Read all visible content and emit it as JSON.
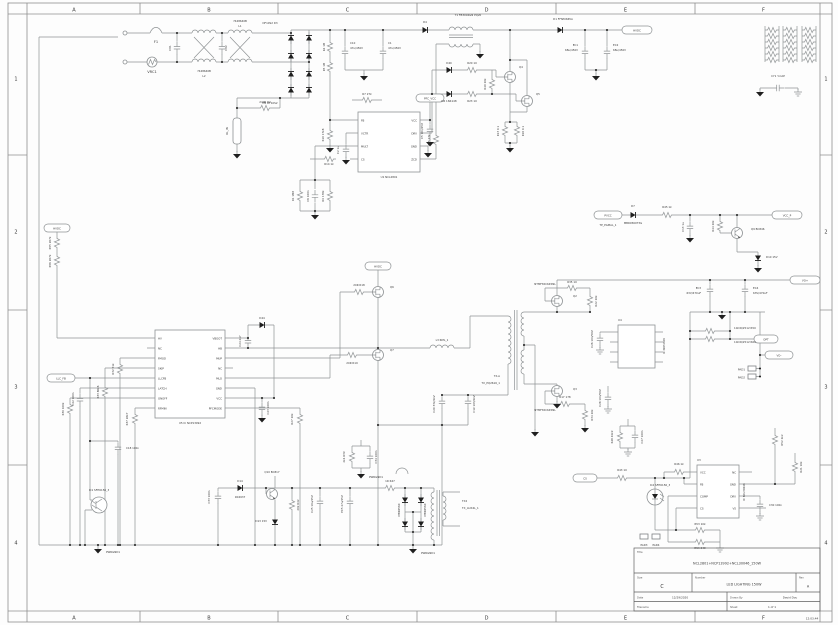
{
  "sheet": {
    "cols": [
      "A",
      "B",
      "C",
      "D",
      "E",
      "F"
    ],
    "rows": [
      "1",
      "2",
      "3",
      "4"
    ],
    "print_time": "12:03:44"
  },
  "title_block": {
    "title_label": "Title",
    "title": "NCL2801+NCP13992+NCL30046_150W",
    "size_label": "Size",
    "size": "C",
    "number_label": "Number",
    "number": "LED LIGHTING 150W",
    "rev_label": "Rev",
    "rev": "A",
    "date_label": "Date",
    "date": "12/29/2020",
    "drawn_by_label": "Drawn By",
    "drawn_by": "David Dou",
    "filename_label": "Filename",
    "sheet_label": "Sheet",
    "sheet_value": "1    of    1"
  },
  "schematic": {
    "labels": [
      [
        "F1",
        156,
        43
      ],
      [
        "VRC1",
        152,
        73
      ],
      [
        "CX1",
        171,
        48,
        "vs"
      ],
      [
        "CX2",
        227,
        48,
        "vs"
      ],
      [
        "7448640B",
        204,
        72,
        "s"
      ],
      [
        "L2",
        204,
        77,
        "s"
      ],
      [
        "7448640B",
        240,
        22,
        "s"
      ],
      [
        "L1",
        240,
        27,
        "s"
      ],
      [
        "DF10S2 D3",
        270,
        24,
        "s"
      ],
      [
        "D5 DF10S2",
        270,
        104,
        "s"
      ],
      [
        "240R R2",
        265,
        103,
        "s"
      ],
      [
        "RL_IN",
        228,
        131,
        "vs"
      ],
      [
        "C10",
        350,
        44,
        "ls"
      ],
      [
        "47u/450V",
        350,
        49,
        "ls"
      ],
      [
        "C1",
        388,
        44,
        "ls"
      ],
      [
        "47u/450V",
        388,
        49,
        "ls"
      ],
      [
        "R4 1M",
        325,
        47,
        "vs"
      ],
      [
        "R5 1M",
        325,
        67,
        "vs"
      ],
      [
        "R10 17k8",
        324,
        135,
        "vs"
      ],
      [
        "D4",
        425,
        23,
        "s"
      ],
      [
        "T1 FB3004GN PQ20",
        468,
        16,
        "s"
      ],
      [
        "D1 FFSP0665A",
        563,
        20,
        "s"
      ],
      [
        "EC1",
        578,
        46,
        "es"
      ],
      [
        "68u/450V",
        578,
        51,
        "es"
      ],
      [
        "EC2",
        613,
        46,
        "ls"
      ],
      [
        "68u/450V",
        613,
        51,
        "ls"
      ],
      [
        "HVDC",
        637,
        31.3,
        "s"
      ],
      [
        "R15 27k",
        430,
        140,
        "vs"
      ],
      [
        "R7 27k",
        367,
        95,
        "s"
      ],
      [
        "Q4",
        519,
        68,
        "ls"
      ],
      [
        "Q5",
        536,
        95,
        "ls"
      ],
      [
        "D40",
        449,
        64,
        "s"
      ],
      [
        "R20 10",
        472,
        64,
        "s"
      ],
      [
        "D6 1N4148",
        449,
        102,
        "s"
      ],
      [
        "R23 10",
        472,
        102,
        "s"
      ],
      [
        "R40 20k",
        486,
        84,
        "vs"
      ],
      [
        "R13 0.1",
        499,
        131,
        "vs"
      ],
      [
        "R16 0.1",
        524,
        131,
        "vs"
      ],
      [
        "FB",
        361,
        121.3,
        "ls"
      ],
      [
        "VCTR",
        361,
        134.3,
        "ls"
      ],
      [
        "MULT",
        361,
        147.3,
        "ls"
      ],
      [
        "CS",
        361,
        160.3,
        "ls"
      ],
      [
        "VCC",
        417,
        121.3,
        "es"
      ],
      [
        "DRV",
        417,
        134.3,
        "es"
      ],
      [
        "GND",
        417,
        147.3,
        "es"
      ],
      [
        "ZCD",
        417,
        160.3,
        "es"
      ],
      [
        "U1 NCL2801",
        389,
        178,
        "s"
      ],
      [
        "PFC_VCC",
        430,
        99.3,
        "s"
      ],
      [
        "C5 10n/25V",
        423,
        131,
        "vs"
      ],
      [
        "R14 1k",
        329,
        165,
        "s"
      ],
      [
        "C2 1u",
        339,
        150,
        "vs"
      ],
      [
        "R1 1M8",
        294,
        196,
        "vs"
      ],
      [
        "C6 100n",
        309,
        196,
        "vs"
      ],
      [
        "R9 178k",
        324,
        196,
        "vs"
      ],
      [
        "PVCC",
        608,
        216.3,
        "s"
      ],
      [
        "TP_PGMAL_1",
        608,
        226,
        "s"
      ],
      [
        "D7",
        633,
        207,
        "s"
      ],
      [
        "MBR0560T3G",
        633,
        224,
        "s"
      ],
      [
        "R45 1k",
        667,
        208,
        "s"
      ],
      [
        "C13 1u",
        684,
        227,
        "vs"
      ],
      [
        "R44 20k",
        714,
        226,
        "vs"
      ],
      [
        "Q9 BC846",
        751,
        230,
        "ls"
      ],
      [
        "D10 15V",
        766,
        258,
        "ls"
      ],
      [
        "VCC_P",
        787,
        216.3,
        "s"
      ],
      [
        "CY1 Y-CAP",
        778,
        77,
        "s"
      ],
      [
        "HVDC",
        57,
        229.3,
        "s"
      ],
      [
        "R55 267k",
        51,
        243,
        "vs"
      ],
      [
        "R56 267k",
        51,
        261,
        "vs"
      ],
      [
        "HV",
        158,
        339.3,
        "ls"
      ],
      [
        "NC",
        158,
        349.3,
        "ls"
      ],
      [
        "FMOD",
        158,
        359.3,
        "ls"
      ],
      [
        "SKIP",
        158,
        369.3,
        "ls"
      ],
      [
        "LLCFB",
        158,
        379.3,
        "ls"
      ],
      [
        "LATCH",
        158,
        389.3,
        "ls"
      ],
      [
        "ONOFF",
        158,
        399.3,
        "ls"
      ],
      [
        "RFMIN",
        158,
        409.3,
        "ls"
      ],
      [
        "VBOOT",
        222,
        339.3,
        "es"
      ],
      [
        "HB",
        222,
        349.3,
        "es"
      ],
      [
        "MUP",
        222,
        359.3,
        "es"
      ],
      [
        "NC",
        222,
        369.3,
        "es"
      ],
      [
        "MLO",
        222,
        379.3,
        "es"
      ],
      [
        "GND",
        222,
        389.3,
        "es"
      ],
      [
        "VCC",
        222,
        399.3,
        "es"
      ],
      [
        "PFCMODE",
        222,
        409.3,
        "es"
      ],
      [
        "U5 IC NCP13992",
        190,
        424,
        "s"
      ],
      [
        "R32 51k",
        114,
        369,
        "vs"
      ],
      [
        "R33 86k6",
        99,
        392,
        "vs"
      ],
      [
        "LLC_FB",
        61,
        379.3,
        "s"
      ],
      [
        "C22 100n",
        74,
        399,
        "vs"
      ],
      [
        "R30 100k",
        64,
        409,
        "vs"
      ],
      [
        "R37 28k7",
        128,
        419,
        "vs"
      ],
      [
        "C24 4n7",
        241,
        341,
        "vs"
      ],
      [
        "D44",
        262,
        319,
        "s"
      ],
      [
        "C23 100n",
        269,
        408,
        "vs"
      ],
      [
        "R27 20k",
        293,
        419,
        "vs"
      ],
      [
        "IC1 SFH6156_3",
        99,
        491,
        "s"
      ],
      [
        "C18 100n",
        126,
        449,
        "ls"
      ],
      [
        "PWRGND1",
        106,
        553,
        "ls"
      ],
      [
        "20R R18",
        359,
        286,
        "s"
      ],
      [
        "20R R19",
        352,
        364,
        "s"
      ],
      [
        "Q6",
        390,
        288,
        "ls"
      ],
      [
        "Q7",
        390,
        351,
        "ls"
      ],
      [
        "HVDC",
        378,
        267.3,
        "s"
      ],
      [
        "L3 RML_1",
        442,
        341,
        "s"
      ],
      [
        "C20 332/2kV",
        435,
        404,
        "vs"
      ],
      [
        "C19 103/2kV",
        475,
        404,
        "vs"
      ],
      [
        "TX-A",
        500,
        377,
        "es"
      ],
      [
        "TX_PQ2616_1",
        500,
        384,
        "es"
      ],
      [
        "NTMFS5C645NL",
        545,
        285,
        "s"
      ],
      [
        "Q2",
        573,
        297,
        "ls"
      ],
      [
        "R35 10",
        572,
        283,
        "s"
      ],
      [
        "R22 20k",
        597,
        301,
        "vs"
      ],
      [
        "NTMFS5C645NL",
        545,
        411,
        "s"
      ],
      [
        "Q3",
        573,
        390,
        "ls"
      ],
      [
        "R17 178",
        565,
        398,
        "s"
      ],
      [
        "R34 20k",
        593,
        415,
        "vs"
      ],
      [
        "U4",
        618,
        321,
        "ls"
      ],
      [
        "IC NCP4306",
        665,
        346,
        "vs"
      ],
      [
        "C26 10n/50V",
        593,
        339,
        "vs"
      ],
      [
        "C28 10n/50V",
        601,
        398,
        "vs"
      ],
      [
        "EC3",
        701,
        289,
        "es"
      ],
      [
        "63V/470uF",
        701,
        294,
        "es"
      ],
      [
        "EC4",
        753,
        289,
        "ls"
      ],
      [
        "63V/470uF",
        753,
        294,
        "ls"
      ],
      [
        "10mR/2512 R50",
        734,
        329,
        "ls"
      ],
      [
        "10mR/2512 R60",
        734,
        343,
        "ls"
      ],
      [
        "VO+",
        805,
        281.3,
        "s"
      ],
      [
        "VO-",
        779,
        356.3,
        "s"
      ],
      [
        "OPT",
        766,
        340.3,
        "s"
      ],
      [
        "PAD1",
        745,
        370.3,
        "es"
      ],
      [
        "PAD2",
        745,
        378.3,
        "es"
      ],
      [
        "C33 100n",
        210,
        497,
        "vs"
      ],
      [
        "D14",
        240,
        482,
        "s"
      ],
      [
        "1N4937",
        240,
        498,
        "s"
      ],
      [
        "Q10 BC817",
        272,
        473,
        "s"
      ],
      [
        "20k R42",
        299,
        505,
        "vs"
      ],
      [
        "D13 15V",
        267,
        522,
        "es"
      ],
      [
        "C25 10u/25V",
        313,
        504,
        "vs"
      ],
      [
        "EC5 47u/25V",
        343,
        504,
        "vs"
      ],
      [
        "1R R47",
        390,
        482,
        "s"
      ],
      [
        "MBR0560",
        400,
        510,
        "vs"
      ],
      [
        "MBR0560",
        426,
        510,
        "vs"
      ],
      [
        "TX2",
        462,
        502,
        "ls"
      ],
      [
        "TX_AUX4L_1",
        462,
        509,
        "ls"
      ],
      [
        "PWRGND1",
        421,
        554,
        "ls"
      ],
      [
        "2k4 R39",
        345,
        457,
        "vs"
      ],
      [
        "C34 100n",
        377,
        457,
        "vs"
      ],
      [
        "PWRGND1",
        369,
        478,
        "ls"
      ],
      [
        "CS",
        585,
        479.3,
        "s"
      ],
      [
        "R43 10",
        622,
        471,
        "s"
      ],
      [
        "IC2 SFH6156_3",
        660,
        486,
        "s"
      ],
      [
        "R46 1k",
        679,
        465,
        "s"
      ],
      [
        "U3",
        697,
        461,
        "ls"
      ],
      [
        "IC NCL30046",
        745,
        492,
        "vs"
      ],
      [
        "VCC",
        700,
        473.3,
        "ls"
      ],
      [
        "FB",
        700,
        485.3,
        "ls"
      ],
      [
        "COMP",
        700,
        497.3,
        "ls"
      ],
      [
        "CS",
        700,
        509.3,
        "ls"
      ],
      [
        "NC",
        736,
        473.3,
        "es"
      ],
      [
        "GND",
        736,
        485.3,
        "es"
      ],
      [
        "DRV",
        736,
        497.3,
        "es"
      ],
      [
        "VS",
        736,
        509.3,
        "es"
      ],
      [
        "R52 2k2",
        783,
        440,
        "vs"
      ],
      [
        "R21 10k",
        802,
        467,
        "vs"
      ],
      [
        "C30 100n",
        769,
        506,
        "ls"
      ],
      [
        "R53 10k",
        700,
        525,
        "s"
      ],
      [
        "R54 249",
        700,
        549,
        "s"
      ],
      [
        "R48 49k9",
        613,
        437,
        "vs"
      ],
      [
        "C27 100n",
        643,
        437,
        "vs"
      ],
      [
        "PAD3",
        644,
        546,
        "s"
      ],
      [
        "PAD4",
        656,
        546,
        "s"
      ]
    ]
  }
}
